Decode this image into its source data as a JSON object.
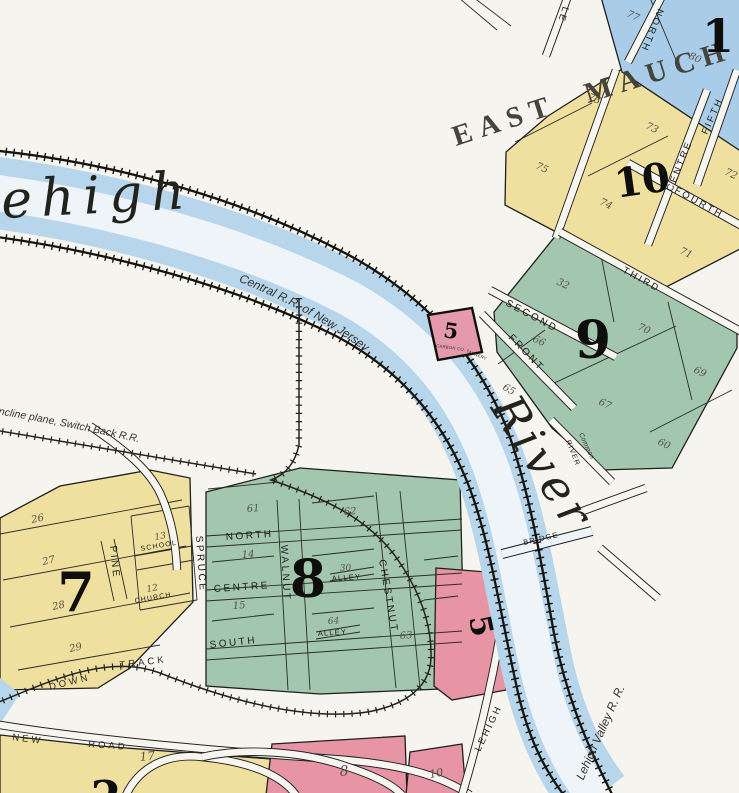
{
  "colors": {
    "paper": "#f6f4ee",
    "block_yellow": "#f0e09f",
    "block_green": "#a2c6ae",
    "block_blue": "#a9cde9",
    "block_pink": "#e794a5",
    "river_blue": "#b7d5eb",
    "ink": "#1f1f1d"
  },
  "city": {
    "name": "EAST MAUCH"
  },
  "river": {
    "word_upper": "Lehigh",
    "word_lower": "River",
    "bridge": "BRIDGE"
  },
  "railroads": {
    "cnj": "Central R.R. of New Jersey",
    "lehigh_valley": "Lehigh Valley R. R.",
    "switchback": "ncline plane, Switch Back R.R.",
    "down": "DOWN",
    "track": "TRACK"
  },
  "roads": {
    "new": "NEW",
    "road": "ROAD",
    "lehigh_st": "LEHIGH",
    "le_partial": "LE",
    "river_st": "RIVER",
    "common": "Common"
  },
  "east_mauch": {
    "block11": {
      "number": "11",
      "lot_77": "77",
      "lot_80": "80",
      "north_st": "NORTH"
    },
    "block10": {
      "number": "10",
      "lot_76": "76",
      "lot_75": "75",
      "lot_73": "73",
      "lot_74": "74",
      "lot_72": "72",
      "lot_71": "71",
      "centre_st": "CENTRE",
      "fourth_st": "FOURTH",
      "third_st": "THIRD",
      "fifth_st": "FIFTH"
    },
    "block9": {
      "number": "9",
      "lot_32": "32",
      "lot_70": "70",
      "lot_66": "66",
      "lot_65": "65",
      "lot_67": "67",
      "lot_69": "69",
      "lot_60": "60",
      "second_st": "SECOND",
      "front_st": "FRONT"
    }
  },
  "mauch_chunk": {
    "block7": {
      "number": "7",
      "lot_26": "26",
      "lot_27": "27",
      "lot_28": "28",
      "lot_29": "29",
      "lot_13": "13",
      "lot_12": "12",
      "school": "SCHOOL",
      "church": "CHURCH",
      "pine_st": "PINE"
    },
    "block8": {
      "number": "8",
      "lot_61": "61",
      "lot_62": "62",
      "lot_14": "14",
      "lot_15": "15",
      "lot_30": "30",
      "lot_64": "64",
      "lot_63": "63",
      "alley": "ALLEY",
      "north_st": "NORTH",
      "centre_st": "CENTRE",
      "south_st": "SOUTH",
      "spruce_st": "SPRUCE",
      "walnut_st": "WALNUT",
      "chestnut_st": "CHESTNUT"
    },
    "tannery": {
      "number": "5",
      "label_line1": "CARBON CO.",
      "label_line2": "TANNERY"
    },
    "block5": {
      "number": "5"
    },
    "block8_south": {
      "number": "8",
      "lot_10": "10"
    },
    "block17": {
      "number": "17"
    },
    "partial_block": {
      "number": "2"
    }
  }
}
